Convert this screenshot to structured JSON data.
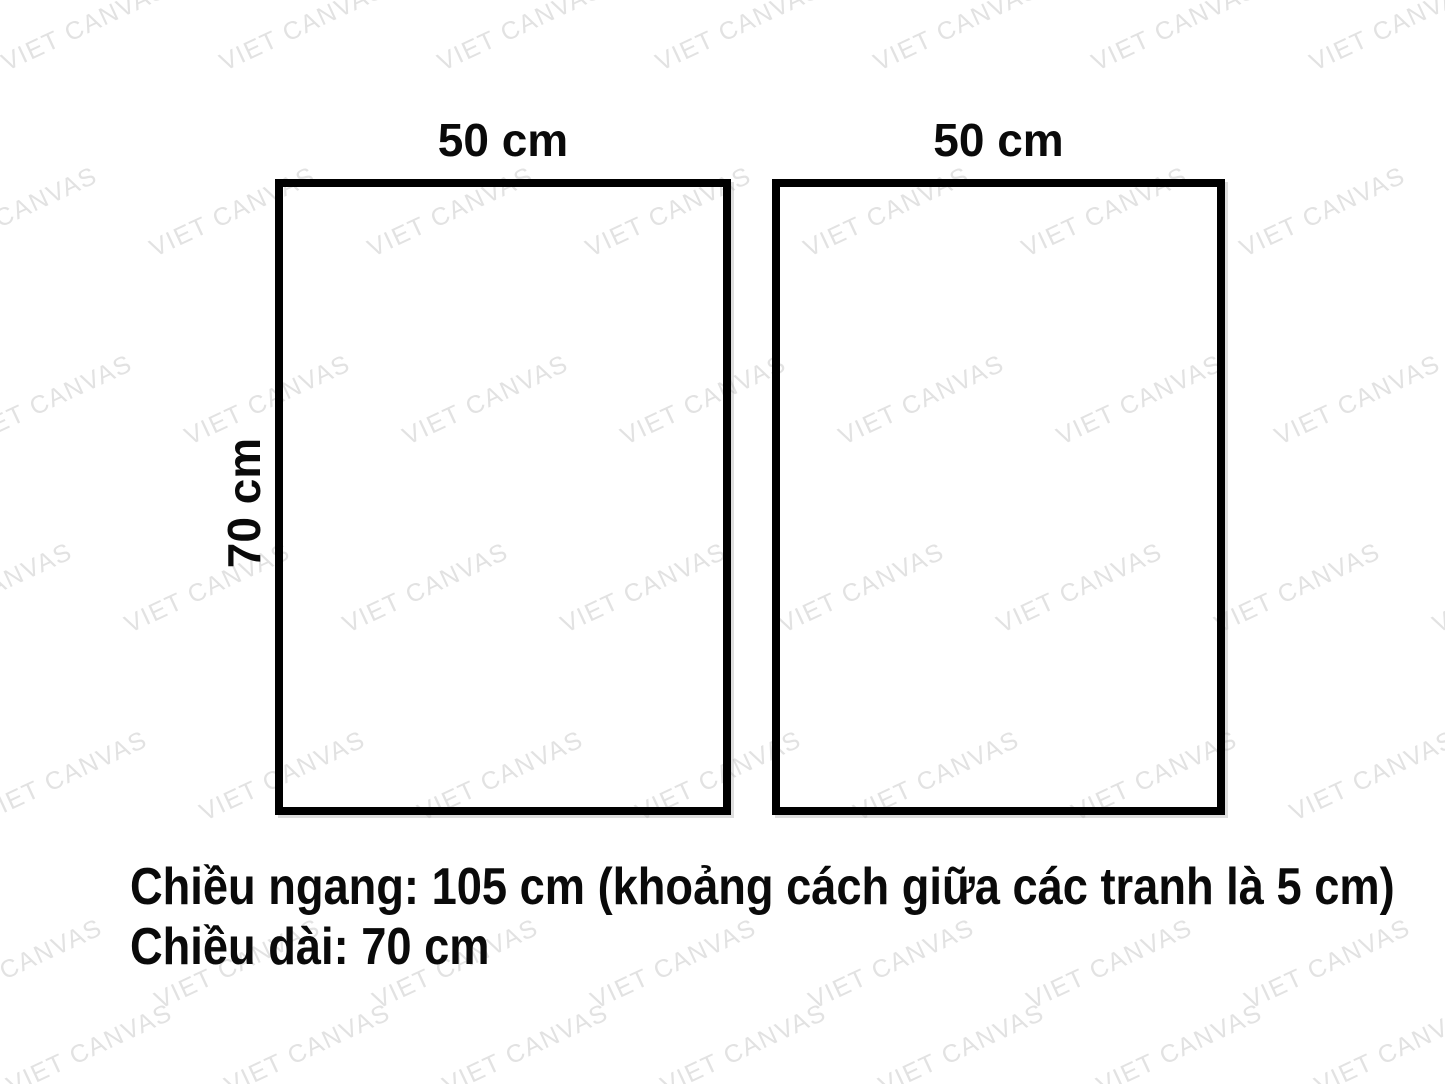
{
  "watermark": {
    "text": "VIET CANVAS",
    "color": "#e2e2e2"
  },
  "diagram": {
    "frames": [
      {
        "width_label": "50 cm"
      },
      {
        "width_label": "50 cm"
      }
    ],
    "height_label": "70 cm"
  },
  "caption": {
    "line1": "Chiều ngang: 105 cm (khoảng cách giữa các tranh là 5 cm)",
    "line2": "Chiều dài: 70 cm"
  },
  "colors": {
    "border": "#000000",
    "text": "#0a0a0a"
  }
}
